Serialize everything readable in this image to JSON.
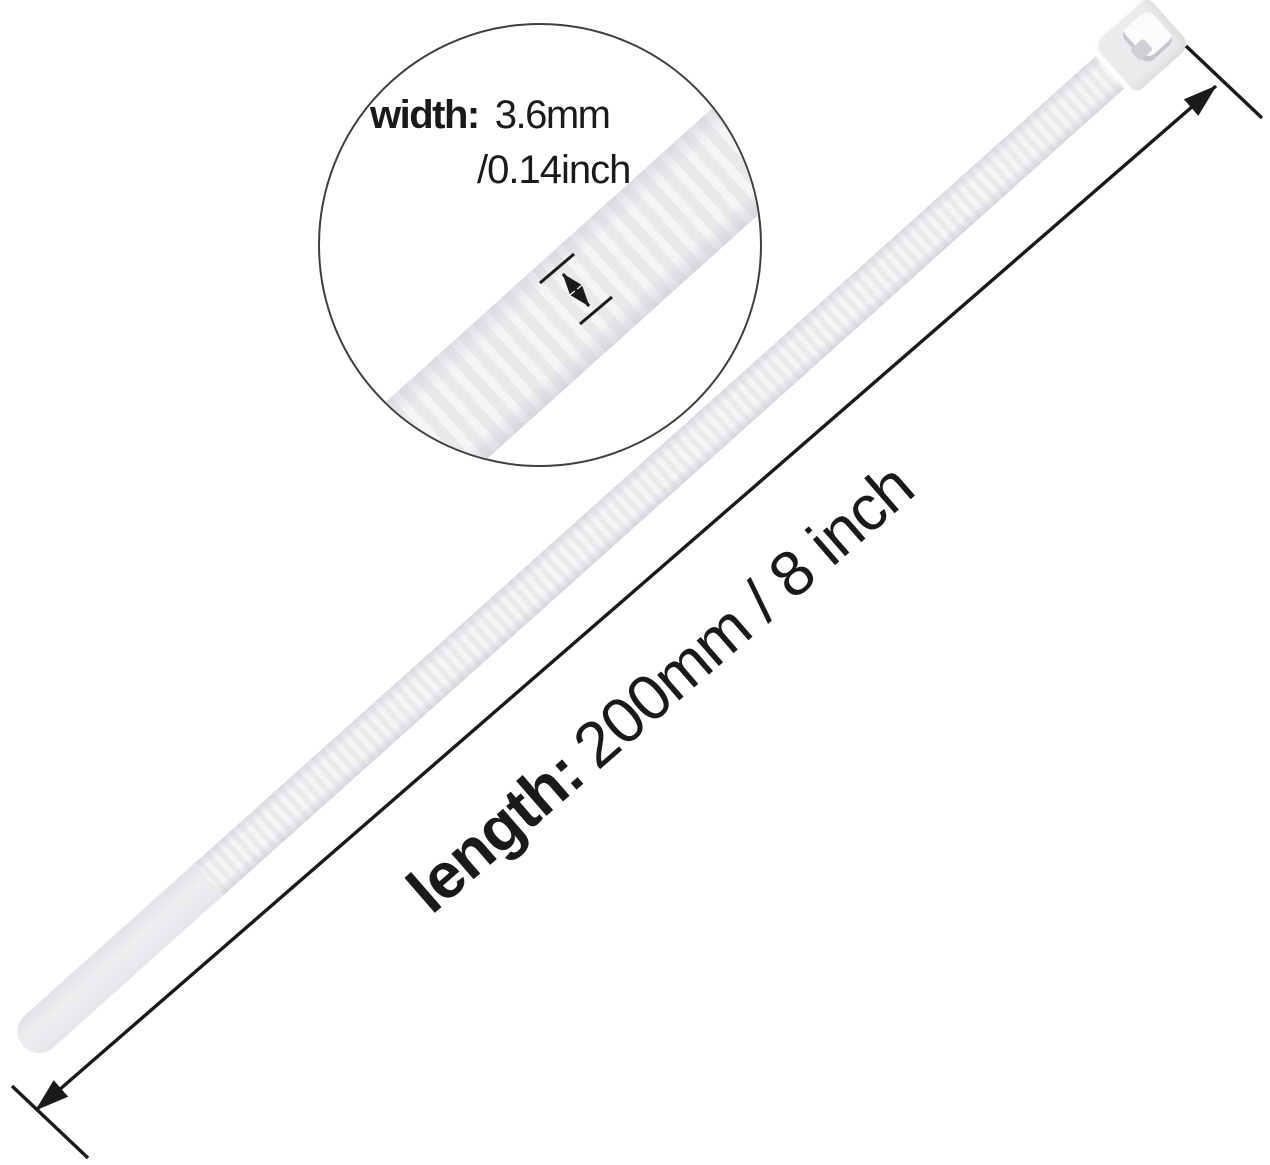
{
  "figure": {
    "type": "product-dimension-diagram",
    "subject": "white nylon cable zip tie with magnified band detail",
    "width_callout": {
      "label": "width:",
      "metric": "3.6mm",
      "imperial": "/0.14inch"
    },
    "length_callout": {
      "label": "length:",
      "value": "200mm / 8 inch"
    }
  },
  "colors": {
    "background": "#ffffff",
    "tie_band": "#ededef",
    "tie_rib_highlight": "#f5f5f7",
    "dimension_lines": "#1a1a1a",
    "magnifier_stroke": "#3f3f3f",
    "text": "#1a1a1a"
  }
}
